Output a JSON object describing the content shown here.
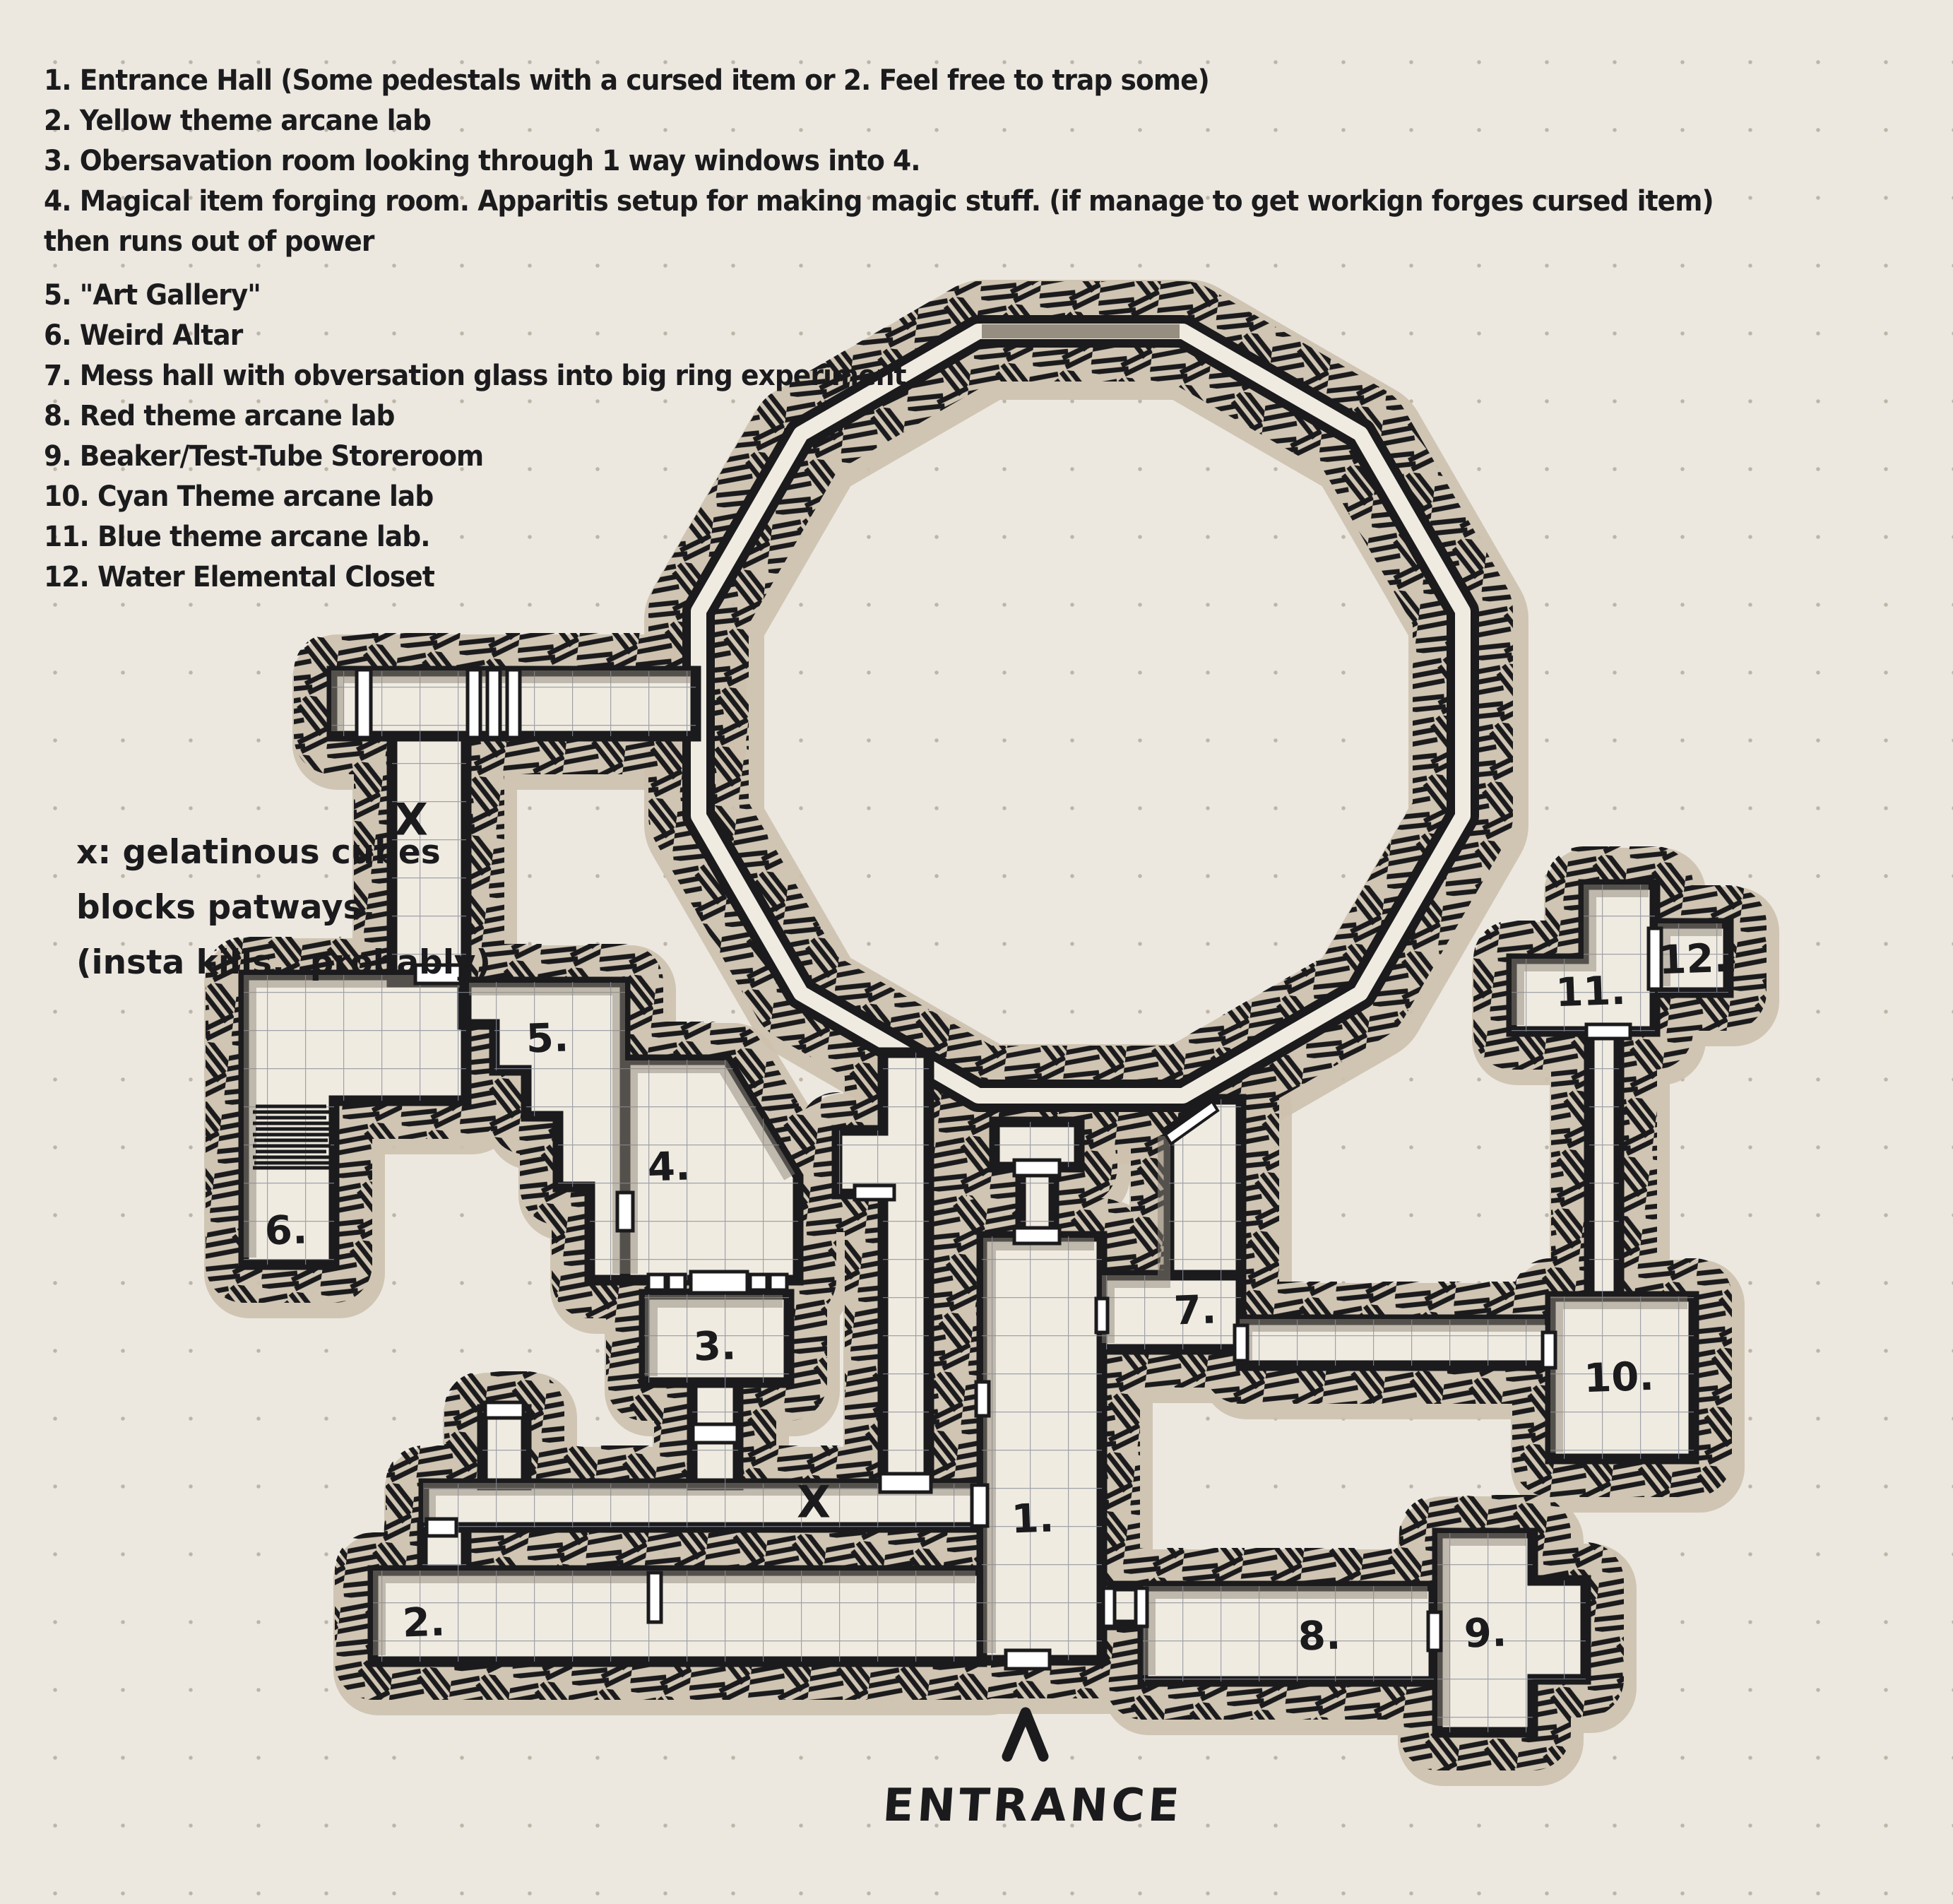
{
  "legend": {
    "lines": [
      "1. Entrance Hall (Some pedestals with a cursed item or 2. Feel free to trap some)",
      "2. Yellow theme arcane lab",
      "3. Obersavation room looking through 1 way windows into 4.",
      "4. Magical item forging room. Apparitis setup for making magic stuff. (if manage to get workign forges cursed item)",
      "then runs out of power",
      "5. \"Art Gallery\"",
      "6. Weird Altar",
      "7. Mess hall with obversation glass into big ring experiment",
      "8. Red theme arcane lab",
      "9. Beaker/Test-Tube Storeroom",
      "10. Cyan Theme arcane lab",
      "11. Blue theme arcane lab.",
      "12. Water Elemental Closet"
    ]
  },
  "note": {
    "lines": [
      "x: gelatinous cubes",
      "blocks patways.",
      "(insta kills...probably)"
    ]
  },
  "entrance": {
    "label": "ENTRANCE"
  },
  "map": {
    "room_labels": [
      {
        "text": "1."
      },
      {
        "text": "2."
      },
      {
        "text": "3."
      },
      {
        "text": "4."
      },
      {
        "text": "5."
      },
      {
        "text": "6."
      },
      {
        "text": "7."
      },
      {
        "text": "8."
      },
      {
        "text": "9."
      },
      {
        "text": "10."
      },
      {
        "text": "11."
      },
      {
        "text": "12."
      }
    ],
    "x_marks": [
      {
        "text": "X"
      },
      {
        "text": "X"
      }
    ],
    "colors": {
      "paper": "#ece8e0",
      "ink": "#1b1b1d",
      "floor": "#f0ebe1",
      "rubble_tan": "#cdc1ae",
      "grid_line": "#8b909b",
      "door": "#ffffff",
      "shadow": "#8d857a"
    }
  }
}
